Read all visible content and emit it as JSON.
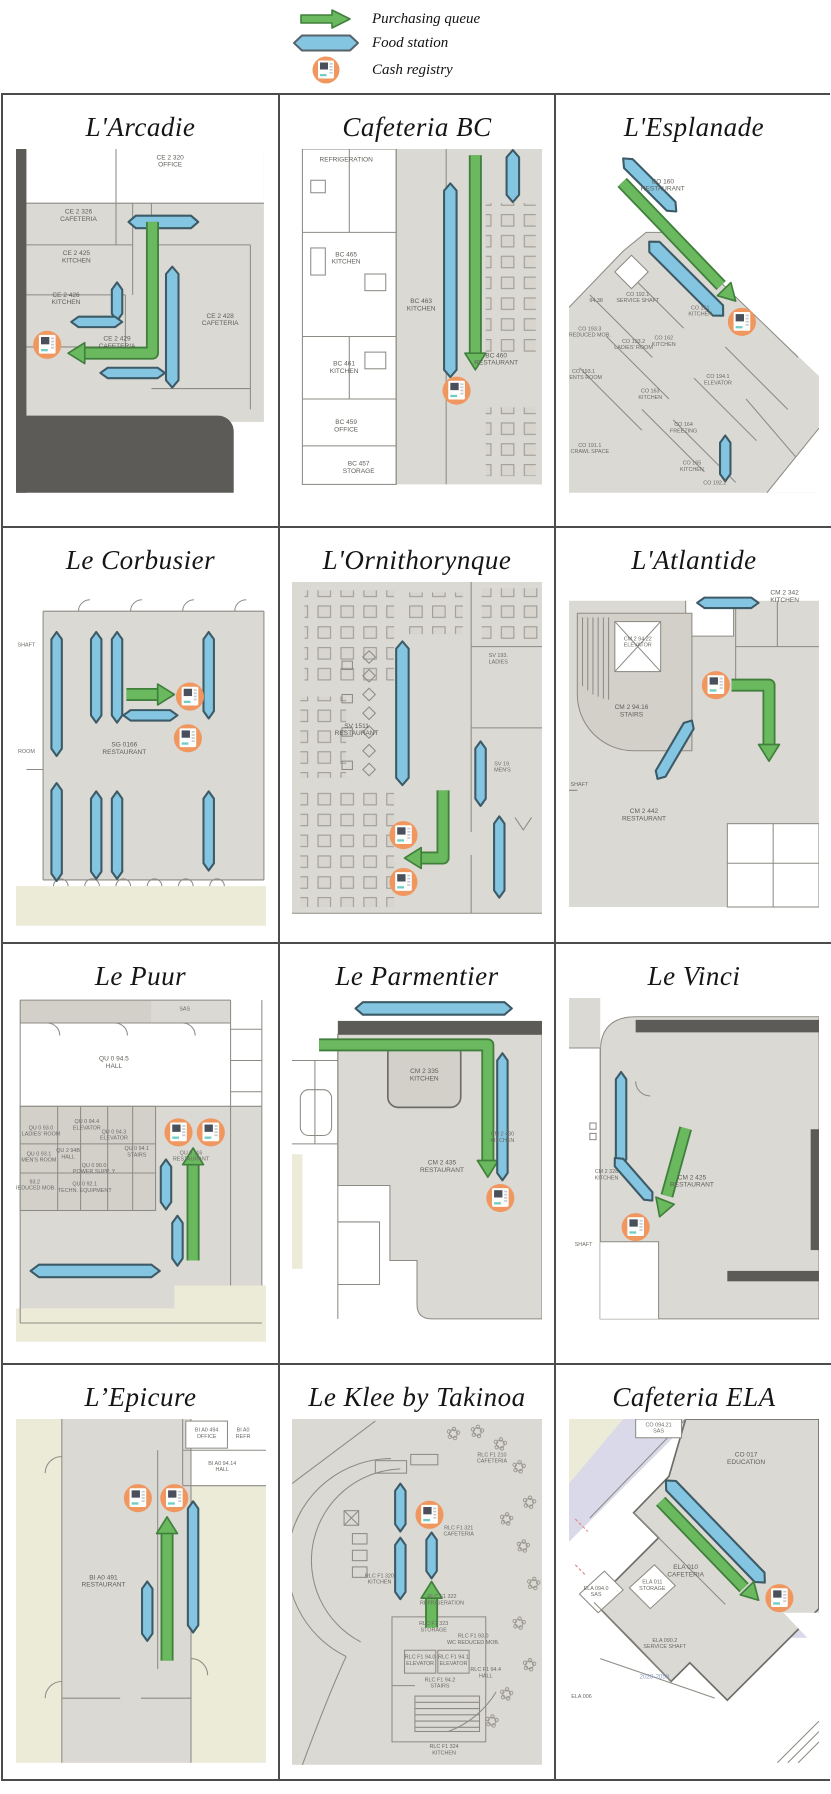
{
  "legend": {
    "items": [
      {
        "icon": "purchasing-queue-arrow-icon",
        "label": "Purchasing queue"
      },
      {
        "icon": "food-station-icon",
        "label": "Food station"
      },
      {
        "icon": "cash-registry-icon",
        "label": "Cash registry"
      }
    ]
  },
  "colors": {
    "queue_green": "#6ab95f",
    "queue_green_outline": "#40803c",
    "station_blue": "#84c6e2",
    "station_blue_outline": "#3d5a67",
    "registry_orange": "#f0975f",
    "plan_gray": "#dbd9d3",
    "plan_beige": "#ecebd8",
    "plan_lavender": "#d9d9e9"
  },
  "cells": [
    {
      "title": "L'Arcadie",
      "rooms": [
        [
          "CE 2 320",
          "OFFICE"
        ],
        [
          "CE 2 326",
          "CAFETERIA"
        ],
        [
          "CE 2 425",
          "KITCHEN"
        ],
        [
          "CE 2 426",
          "KITCHEN"
        ],
        [
          "CE 2 429",
          "CAFETERIA"
        ],
        [
          "CE 2 428",
          "CAFETERIA"
        ]
      ]
    },
    {
      "title": "Cafeteria BC",
      "rooms": [
        [
          "REFRIGERATION"
        ],
        [
          "BC 465",
          "KITCHEN"
        ],
        [
          "BC 463",
          "KITCHEN"
        ],
        [
          "BC 461",
          "KITCHEN"
        ],
        [
          "BC 459",
          "OFFICE"
        ],
        [
          "BC 457",
          "STORAGE"
        ],
        [
          "BC 460",
          "RESTAURANT"
        ]
      ]
    },
    {
      "title": "L'Esplanade",
      "rooms": [
        [
          "CO 160",
          "RESTAURANT"
        ],
        [
          "CO 192.1",
          "SERVICE SHAFT"
        ],
        [
          "94.38"
        ],
        [
          "CO 161",
          "KITCHEN"
        ],
        [
          "CO 162",
          "KITCHEN"
        ],
        [
          "CO 193.3",
          "REDUCED MOB."
        ],
        [
          "CO 193.2",
          "LADIES' ROOM"
        ],
        [
          "CO 193.1",
          "GENTS ROOM"
        ],
        [
          "CO 163",
          "KITCHEN"
        ],
        [
          "CO 164",
          "FREEZING"
        ],
        [
          "CO 194.1",
          "ELEVATOR"
        ],
        [
          "CO 191.1",
          "CRAWL SPACE"
        ],
        [
          "CO 165",
          "KITCHEN"
        ],
        [
          "CO 192.2"
        ]
      ]
    },
    {
      "title": "Le Corbusier",
      "rooms": [
        [
          "SHAFT"
        ],
        [
          "SG 0166",
          "RESTAURANT"
        ],
        [
          "ROOM"
        ]
      ]
    },
    {
      "title": "L'Ornithorynque",
      "rooms": [
        [
          "SV 1511",
          "RESTAURANT"
        ],
        [
          "SV 193.",
          "LADIES"
        ],
        [
          "SV 19.",
          "MEN'S"
        ]
      ]
    },
    {
      "title": "L'Atlantide",
      "rooms": [
        [
          "CM 2 94.22",
          "ELEVATOR"
        ],
        [
          "CM 2 94.16",
          "STAIRS"
        ],
        [
          "CM 2 342",
          "KITCHEN"
        ],
        [
          "CM 2 442",
          "RESTAURANT"
        ],
        [
          "SHAFT"
        ]
      ]
    },
    {
      "title": "Le Puur",
      "rooms": [
        [
          "SAS"
        ],
        [
          "QU 0 94.5",
          "HALL"
        ],
        [
          "QU 0 93.0",
          "LADIES' ROOM"
        ],
        [
          "QU 0 94.4",
          "ELEVATOR"
        ],
        [
          "QU 0 94.3",
          "ELEVATOR"
        ],
        [
          "QU 0 94.1",
          "STAIRS"
        ],
        [
          "QU 0 93.1",
          "MEN'S ROOM"
        ],
        [
          "QU 2 94B",
          "HALL"
        ],
        [
          "QU 0 90.0",
          "POWER SUPP. Y"
        ],
        [
          "93.2",
          "REDUCED MOB."
        ],
        [
          "QU 0 92.1",
          "TECHN. EQUIPMENT"
        ],
        [
          "QU 0 116",
          "RESTAURANT"
        ]
      ]
    },
    {
      "title": "Le Parmentier",
      "rooms": [
        [
          "CM 2 335",
          "KITCHEN"
        ],
        [
          "CM 2 435",
          "RESTAURANT"
        ],
        [
          "CM 2 430",
          "KITCHEN"
        ]
      ]
    },
    {
      "title": "Le Vinci",
      "rooms": [
        [
          "CM 2 328",
          "KITCHEN"
        ],
        [
          "CM 2 425",
          "RESTAURANT"
        ],
        [
          "SHAFT"
        ]
      ]
    },
    {
      "title": "L’Epicure",
      "rooms": [
        [
          "BI A0 494",
          "OFFICE"
        ],
        [
          "BI A0",
          "REFR"
        ],
        [
          "BI A0 94.14",
          "HALL"
        ],
        [
          "BI A0 491",
          "RESTAURANT"
        ]
      ]
    },
    {
      "title": "Le Klee by Takinoa",
      "rooms": [
        [
          "RLC F1 210",
          "CAFETERIA"
        ],
        [
          "RLC F1 321",
          "CAFETERIA"
        ],
        [
          "RLC F1 320",
          "KITCHEN"
        ],
        [
          "RLC F1 322",
          "REFRIGERATION"
        ],
        [
          "RLC F1 323",
          "STORAGE"
        ],
        [
          "RLC F1 93.0",
          "WC REDUCED MOB."
        ],
        [
          "RLC F1 94.0",
          "ELEVATOR"
        ],
        [
          "RLC F1 94.1",
          "ELEVATOR"
        ],
        [
          "RLC F1 94.4",
          "HALL"
        ],
        [
          "RLC F1 94.2",
          "STAIRS"
        ],
        [
          "RLC F1 324",
          "KITCHEN"
        ]
      ]
    },
    {
      "title": "Cafeteria ELA",
      "rooms": [
        [
          "CO 094.21",
          "SAS"
        ],
        [
          "CO 017",
          "EDUCATION"
        ],
        [
          "ELA 010",
          "CAFETERIA"
        ],
        [
          "ELA 094.0",
          "SAS"
        ],
        [
          "ELA 011",
          "STORAGE"
        ],
        [
          "ELA 090.2",
          "SERVICE SHAFT"
        ],
        [
          "2028-2058"
        ],
        [
          "ELA 006"
        ]
      ]
    }
  ]
}
